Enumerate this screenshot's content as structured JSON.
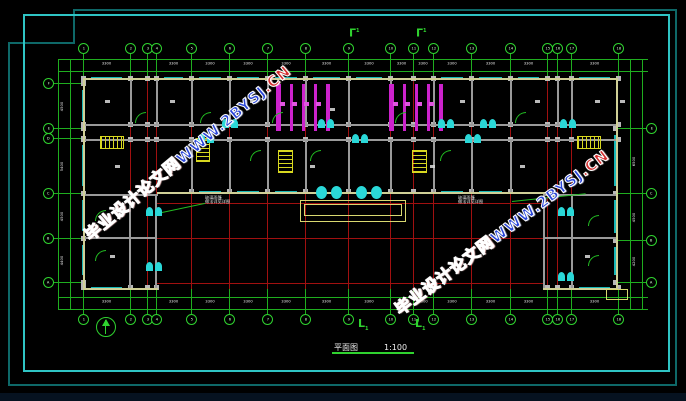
{
  "watermark": {
    "site_name": "毕业设计论文网",
    "url_main": "WWW.2BYSJ",
    "url_tail": ".CN"
  },
  "title": {
    "name": "平面图",
    "scale": "1:100"
  },
  "section": {
    "top_glyph": "Γ",
    "bottom_glyph": "L",
    "mark_no": "1"
  },
  "annotations": {
    "left": {
      "line1": "玻璃雨篷",
      "line2": "做法详见详图"
    },
    "right": {
      "line1": "玻璃雨篷",
      "line2": "做法详见详图"
    }
  },
  "dimensions": {
    "bay_value": "3300",
    "left_values": [
      "4500",
      "900",
      "5400",
      "4500",
      "4400"
    ],
    "right_values": [
      "6500",
      "4500",
      "4200"
    ]
  },
  "plan": {
    "axes_x": [
      83,
      130,
      147,
      156,
      191,
      229,
      267,
      305,
      348,
      390,
      413,
      433,
      471,
      510,
      547,
      557,
      571,
      618
    ],
    "axes_x_labels": [
      "1",
      "2",
      "3",
      "4",
      "5",
      "6",
      "7",
      "8",
      "9",
      "10",
      "11",
      "12",
      "13",
      "14",
      "15",
      "16",
      "17",
      "18"
    ],
    "left_axes": [
      {
        "y": 83,
        "label": "F"
      },
      {
        "y": 128,
        "label": "E"
      },
      {
        "y": 138,
        "label": "D"
      },
      {
        "y": 193,
        "label": "C"
      },
      {
        "y": 238,
        "label": "B"
      },
      {
        "y": 282,
        "label": "A"
      }
    ],
    "right_axes": [
      {
        "y": 128,
        "label": "E"
      },
      {
        "y": 193,
        "label": "C"
      },
      {
        "y": 240,
        "label": "B"
      },
      {
        "y": 282,
        "label": "A"
      }
    ],
    "walls_gray": [
      [
        83,
        124,
        535,
        2
      ],
      [
        83,
        139,
        535,
        2
      ],
      [
        83,
        194,
        75,
        2
      ],
      [
        543,
        194,
        75,
        2
      ],
      [
        129,
        196,
        2,
        92
      ],
      [
        155,
        196,
        2,
        92
      ],
      [
        543,
        196,
        2,
        92
      ],
      [
        571,
        196,
        2,
        92
      ],
      [
        83,
        237,
        74,
        2
      ],
      [
        545,
        237,
        73,
        2
      ]
    ],
    "partitions_upper_x": [
      130,
      156,
      191,
      229,
      267,
      305,
      348,
      390,
      433,
      471,
      510,
      557,
      571
    ],
    "partitions_lower_x": [
      191,
      229,
      267,
      305,
      348,
      390,
      433,
      471,
      510
    ],
    "walls_yellow": [
      [
        83,
        78,
        535,
        2
      ],
      [
        83,
        78,
        2,
        212
      ],
      [
        616,
        78,
        2,
        212
      ],
      [
        83,
        288,
        75,
        2
      ],
      [
        543,
        288,
        75,
        2
      ],
      [
        157,
        192,
        388,
        2
      ]
    ],
    "canopy": [
      300,
      200,
      104,
      20
    ],
    "steps_right": [
      606,
      289,
      20,
      9
    ],
    "red_h": [
      [
        157,
        203,
        388
      ],
      [
        83,
        238,
        535
      ],
      [
        157,
        283,
        388
      ]
    ],
    "stairs": [
      [
        101,
        137,
        22,
        11,
        "v"
      ],
      [
        578,
        137,
        22,
        11,
        "v"
      ],
      [
        197,
        139,
        12,
        22,
        "h"
      ],
      [
        279,
        151,
        13,
        21,
        "h"
      ],
      [
        413,
        151,
        13,
        21,
        "h"
      ]
    ],
    "toilets": [
      [
        276,
        84,
        49,
        47
      ],
      [
        389,
        84,
        49,
        47
      ]
    ],
    "doors_cyan": [
      [
        222,
        119
      ],
      [
        318,
        119
      ],
      [
        352,
        134
      ],
      [
        438,
        119
      ],
      [
        465,
        134
      ],
      [
        480,
        119
      ],
      [
        560,
        119
      ],
      [
        198,
        134
      ]
    ],
    "entry_doors": [
      [
        316,
        186
      ],
      [
        356,
        186
      ]
    ],
    "wing_doors": [
      [
        146,
        207
      ],
      [
        146,
        262
      ],
      [
        558,
        207
      ],
      [
        558,
        272
      ]
    ],
    "arcs": [
      [
        135,
        112
      ],
      [
        200,
        112
      ],
      [
        272,
        112
      ],
      [
        395,
        112
      ],
      [
        515,
        112
      ],
      [
        310,
        150
      ],
      [
        440,
        150
      ],
      [
        250,
        150
      ],
      [
        95,
        210
      ],
      [
        95,
        250
      ],
      [
        588,
        215
      ],
      [
        588,
        255
      ]
    ],
    "room_marks": [
      [
        105,
        100
      ],
      [
        170,
        100
      ],
      [
        250,
        100
      ],
      [
        460,
        100
      ],
      [
        535,
        100
      ],
      [
        595,
        100
      ],
      [
        115,
        165
      ],
      [
        310,
        165
      ],
      [
        430,
        165
      ],
      [
        520,
        165
      ],
      [
        110,
        255
      ],
      [
        585,
        255
      ],
      [
        330,
        108
      ],
      [
        620,
        100
      ]
    ]
  }
}
